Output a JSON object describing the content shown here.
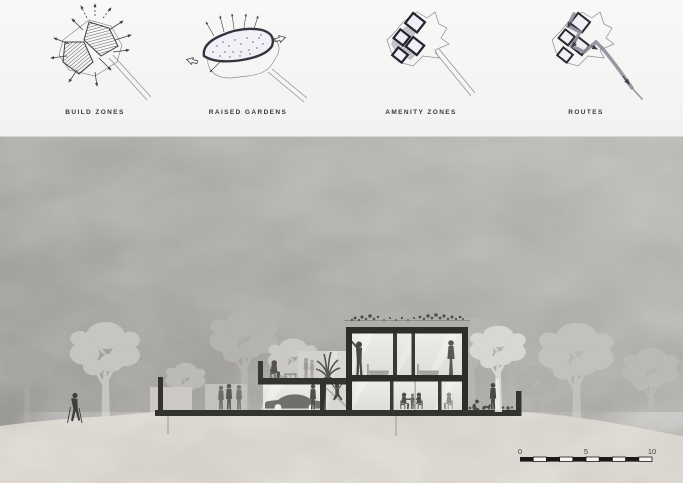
{
  "board": {
    "concept_diagrams": [
      {
        "id": "build-zones",
        "label": "BUILD ZONES"
      },
      {
        "id": "raised-gardens",
        "label": "RAISED GARDENS"
      },
      {
        "id": "amenity-zones",
        "label": "AMENITY ZONES"
      },
      {
        "id": "routes",
        "label": "ROUTES"
      }
    ],
    "section": {
      "scale_bar": {
        "ticks": [
          "0",
          "5",
          "10"
        ],
        "segments": 10
      }
    },
    "colors": {
      "panel_bg": "#f3f2f0",
      "sketch_ink": "#3e3d49",
      "label_ink": "#3b3a38",
      "section_bg_dark": "#989693",
      "section_bg_light": "#b9b7b3",
      "ground": "#d7d2ca",
      "building_dark": "#2d2d2b",
      "glass": "#e9e7e4",
      "tree_light": "#c7c5c1",
      "figure_dark": "#4a4846"
    }
  }
}
